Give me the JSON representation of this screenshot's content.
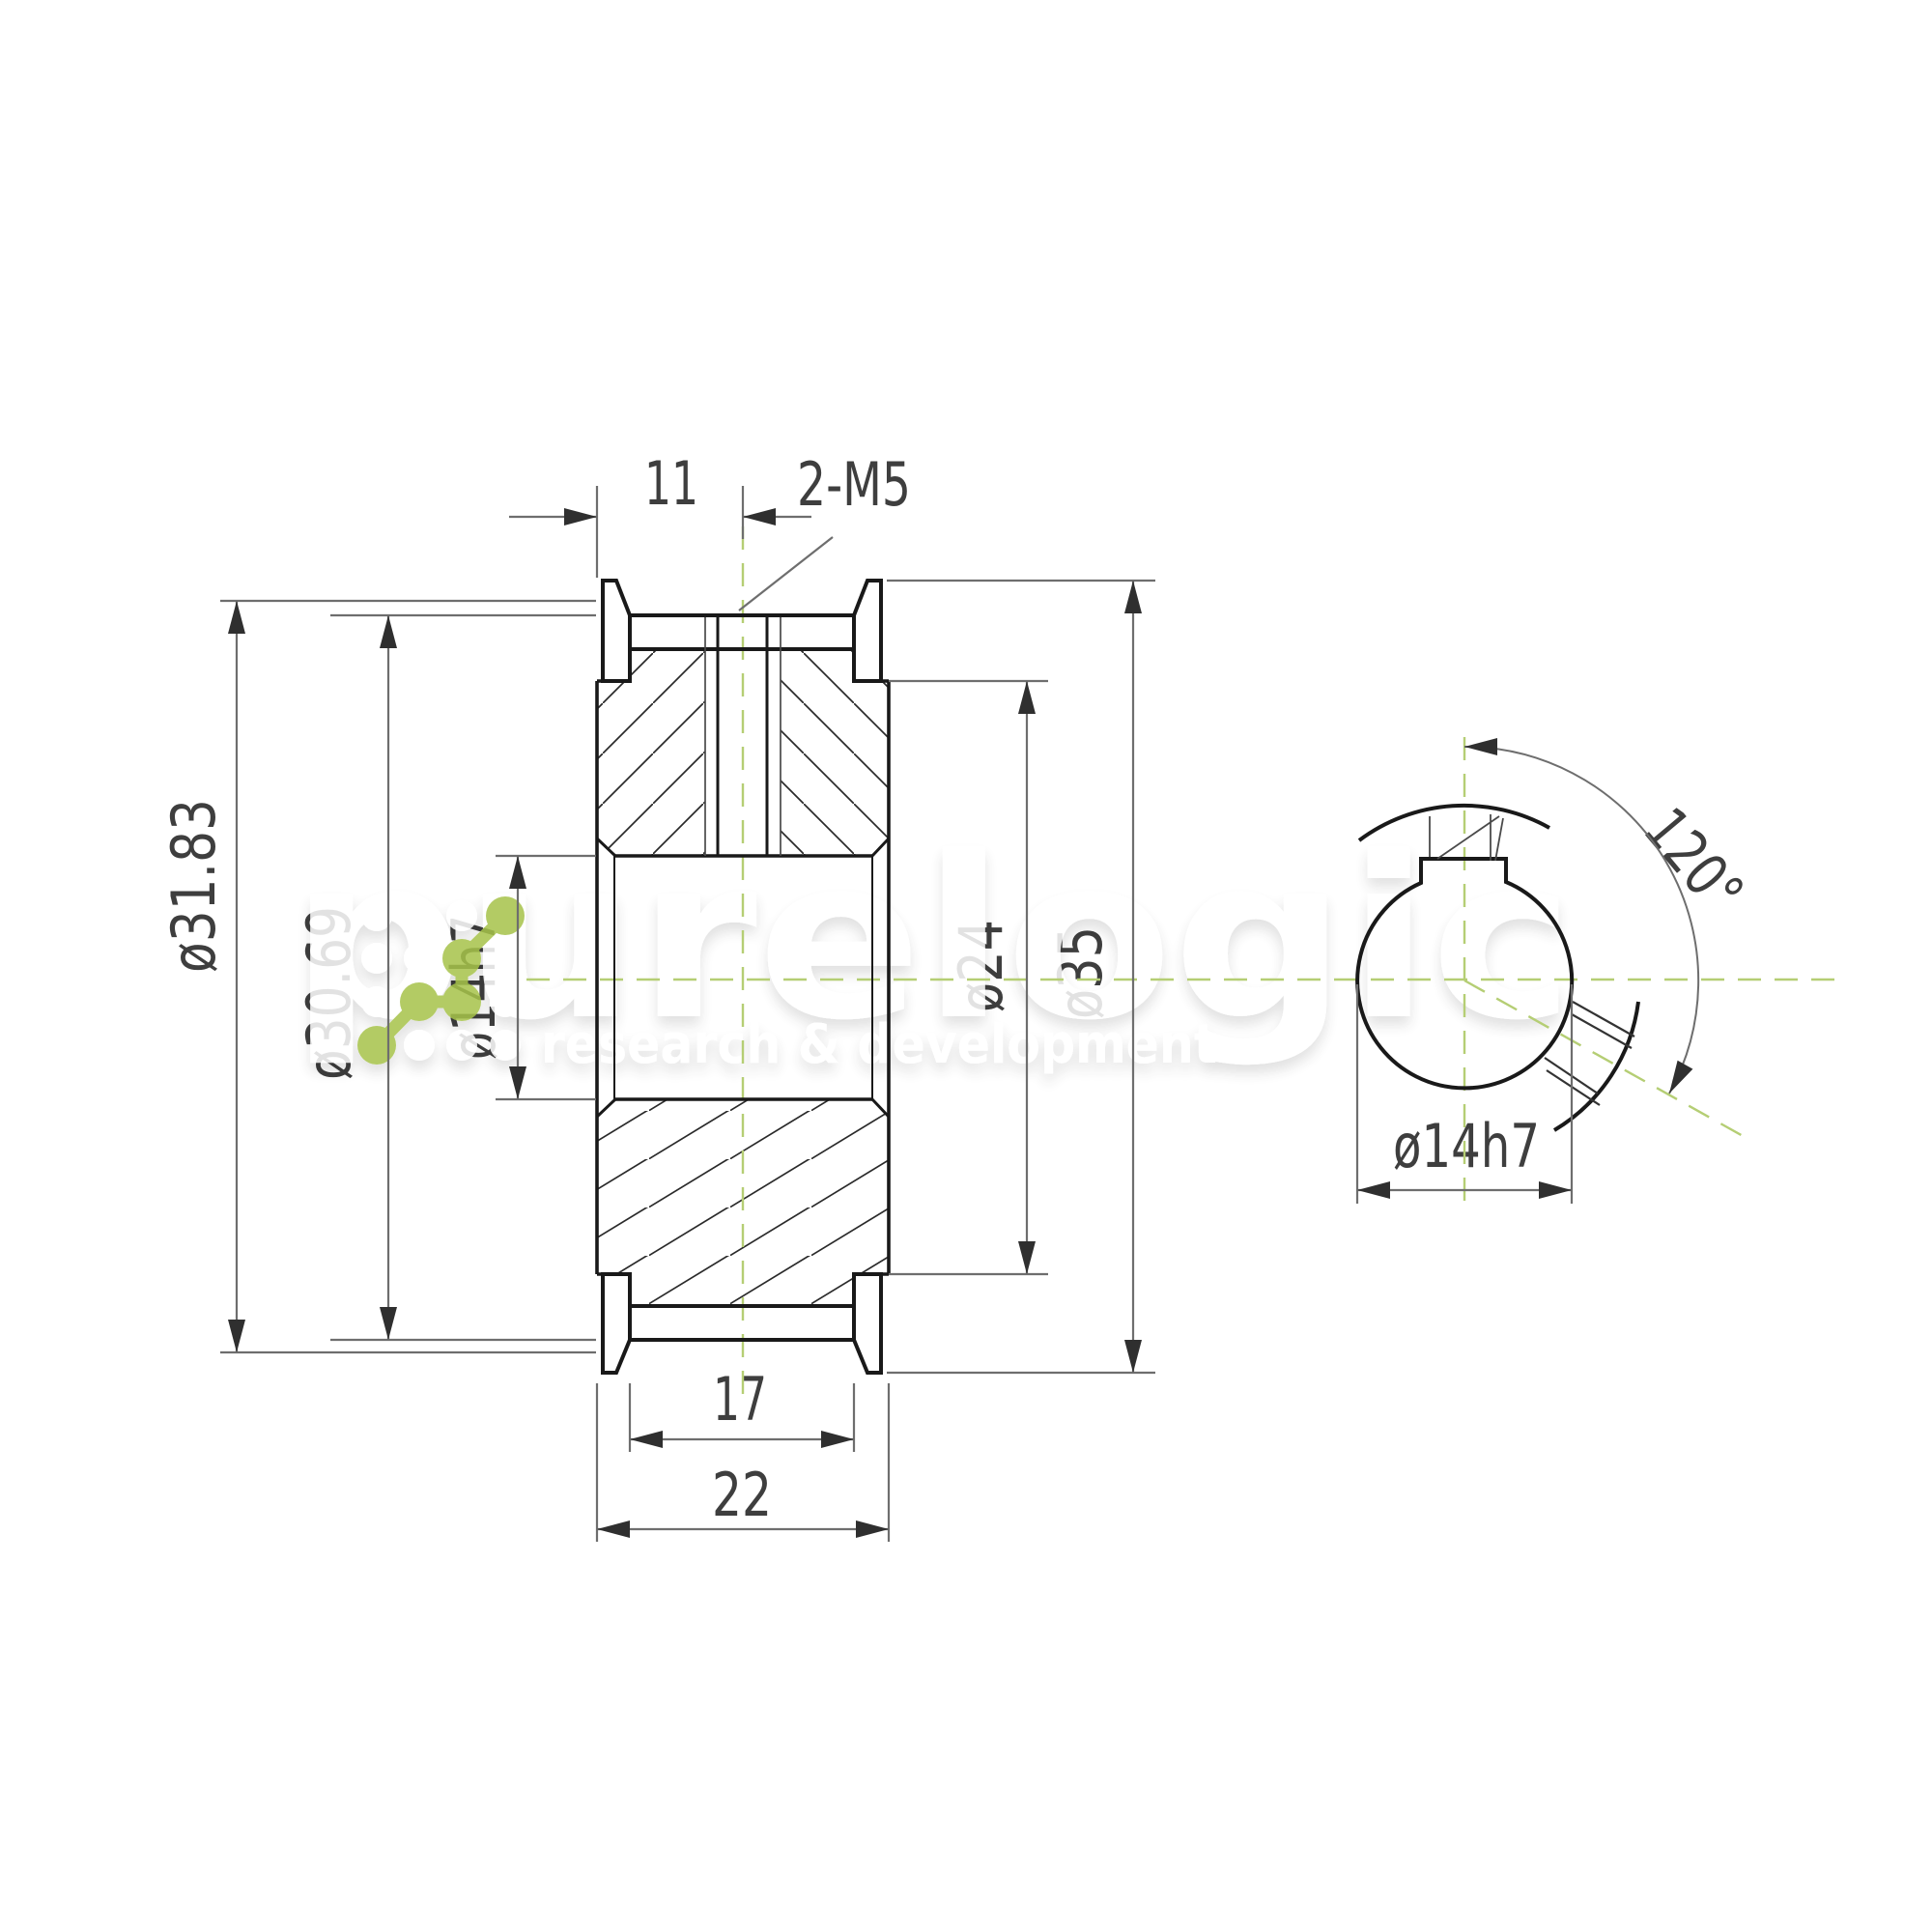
{
  "drawing": {
    "title": "timing pulley technical drawing",
    "labels": {
      "dim_11": "11",
      "dim_2m5": "2-M5",
      "dim_d3183": "ø31.83",
      "dim_d3069": "ø30.69",
      "dim_d14h7_side": "ø14h7",
      "dim_d24": "ø24",
      "dim_d35": "ø35",
      "dim_17": "17",
      "dim_22": "22",
      "dim_120": "120°",
      "dim_d14h7_end": "ø14h7"
    },
    "watermark": {
      "brand": "purelogic",
      "tagline": "research & development"
    },
    "colors": {
      "part_line": "#191919",
      "dim_line": "#6e6e6e",
      "dim_text": "#3e3e3e",
      "centerline_green": "#b5ce74",
      "logo_green": "#a6c348",
      "background": "#ffffff"
    }
  }
}
